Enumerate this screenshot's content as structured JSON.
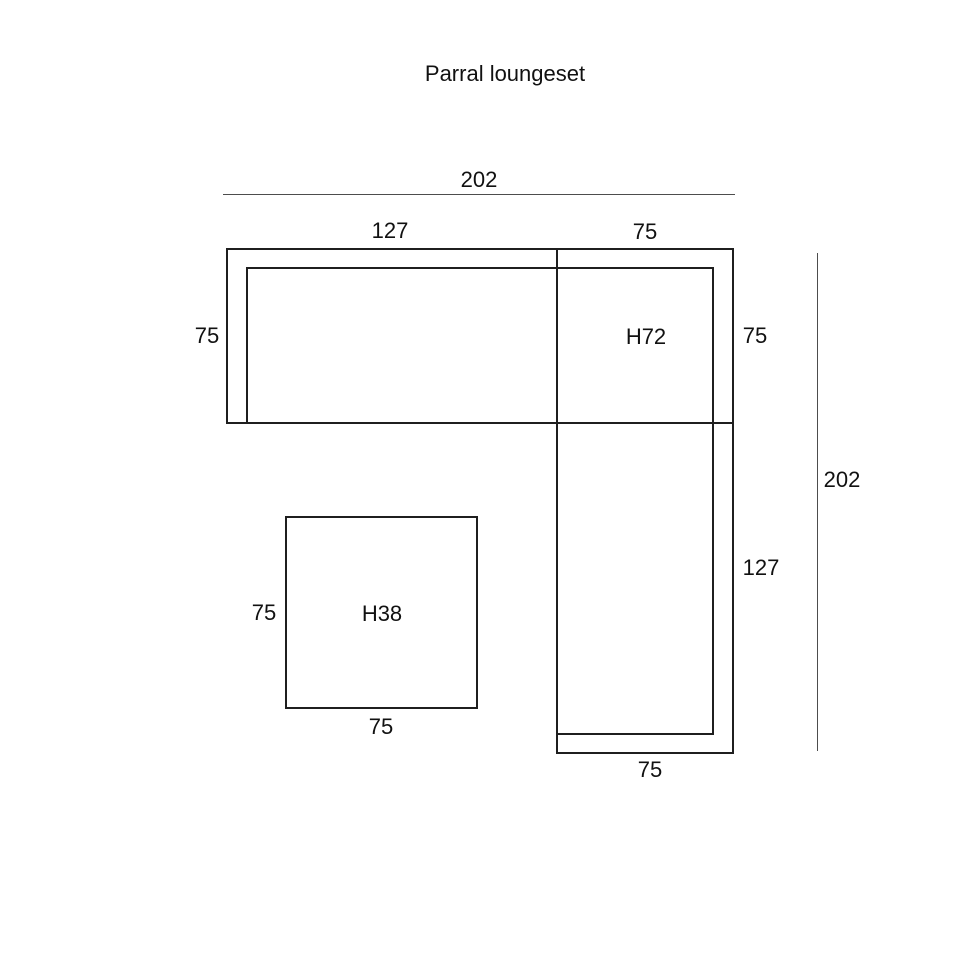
{
  "title": "Parral loungeset",
  "sofa": {
    "top_total_width": "202",
    "top_left_section_width": "127",
    "top_corner_section_width": "75",
    "left_depth": "75",
    "corner_label": "H72",
    "corner_right_depth": "75",
    "right_total_height": "202",
    "right_section_length": "127",
    "bottom_depth": "75"
  },
  "table": {
    "label": "H38",
    "left_side": "75",
    "bottom_side": "75"
  },
  "colors": {
    "shape_line": "#1f1f1f",
    "dimension_line": "#4d4d4d",
    "text": "#111111",
    "background": "#ffffff"
  }
}
